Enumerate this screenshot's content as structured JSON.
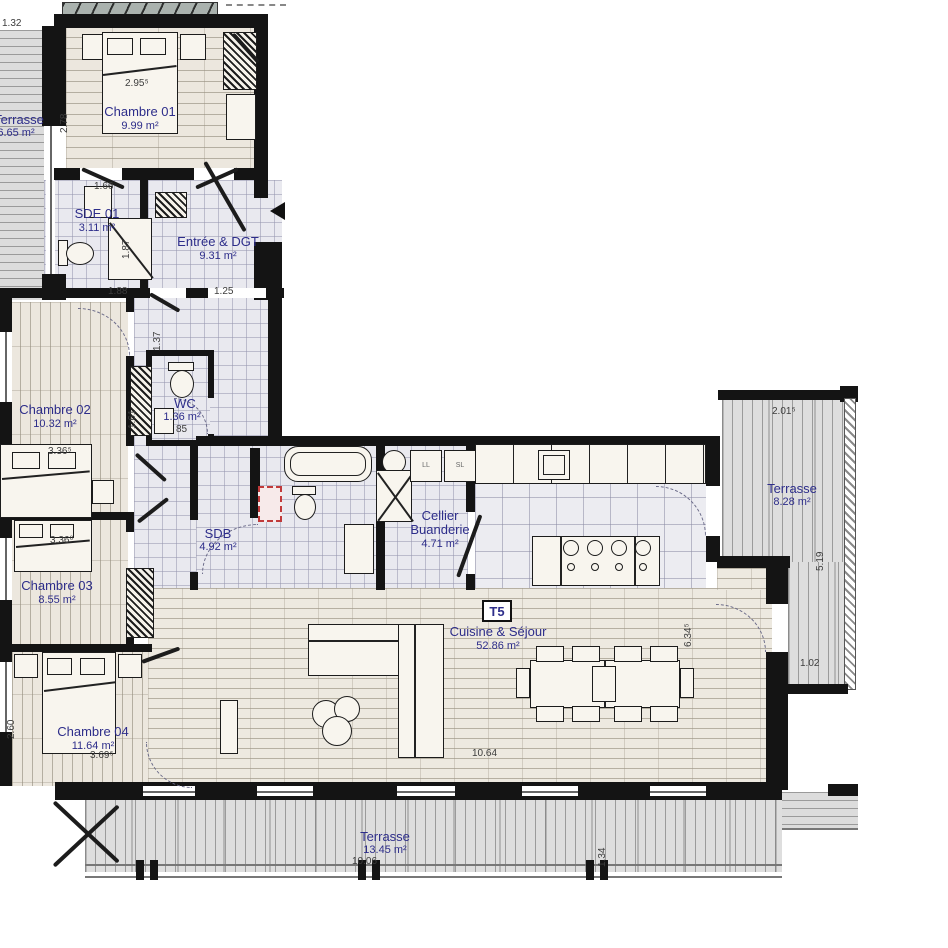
{
  "plan": {
    "badge": "T5",
    "colors": {
      "label": "#2d2d8a",
      "wall": "#141414",
      "dimension": "#3c3c3c"
    },
    "rooms": {
      "terrasse_nw": {
        "name": "Terrasse",
        "area": "6.65 m²"
      },
      "chambre01": {
        "name": "Chambre 01",
        "area": "9.99 m²"
      },
      "sde01": {
        "name": "SDE 01",
        "area": "3.11 m²"
      },
      "entree": {
        "name": "Entrée & DGT",
        "area": "9.31 m²"
      },
      "chambre02": {
        "name": "Chambre 02",
        "area": "10.32 m²"
      },
      "wc": {
        "name": "WC",
        "area": "1.36 m²"
      },
      "chambre03": {
        "name": "Chambre 03",
        "area": "8.55 m²"
      },
      "sdb": {
        "name": "SDB",
        "area": "4.92 m²"
      },
      "cellier": {
        "name": "Cellier",
        "name2": "Buanderie",
        "area": "4.71 m²"
      },
      "cuisine": {
        "name": "Cuisine & Séjour",
        "area": "52.86 m²"
      },
      "chambre04": {
        "name": "Chambre 04",
        "area": "11.64 m²"
      },
      "terrasse_e": {
        "name": "Terrasse",
        "area": "8.28 m²"
      },
      "terrasse_s": {
        "name": "Terrasse",
        "area": "13.45 m²"
      }
    },
    "dimensions": {
      "terrace_nw_width": "1.32",
      "ch01_width": "2.95⁵",
      "ch01_depth": "2.78",
      "sde01_width": "1.66",
      "sde01_depth": "1.87",
      "entree_left": "1.88",
      "entree_right": "1.25",
      "entree_shower": "1.37",
      "ch02_depth": "3.58",
      "ch02_width": "3.36⁵",
      "wc_depth": "1.61",
      "wc_width": "85",
      "ch03_width": "3.36⁰",
      "ch03_depth": "2.82⁵",
      "ch04_depth": "2.60",
      "ch04_width": "3.69⁵",
      "terrace_e_width": "2.01⁵",
      "terrace_e_depth": "5.19",
      "terrace_e_bottom": "1.02",
      "sejour_depth": "6.34⁵",
      "sejour_width": "10.64",
      "terrace_s_width": "10.06",
      "terrace_s_depth": "1.34"
    },
    "appliances": {
      "washer": "LL",
      "dryer": "SL"
    }
  }
}
